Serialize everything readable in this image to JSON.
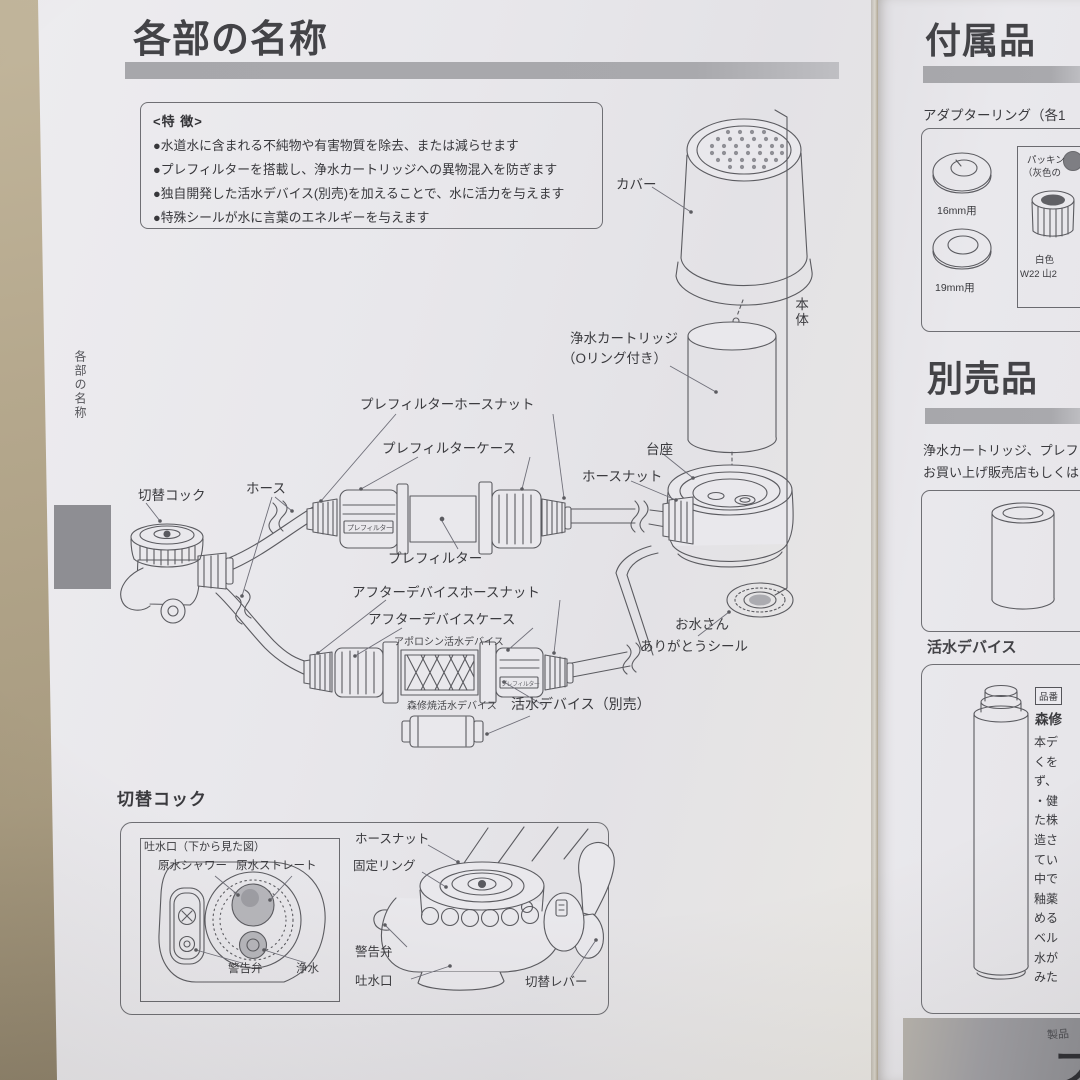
{
  "colors": {
    "table_surface": "#b3a68c",
    "paper": "#e8e7eb",
    "heading_bar": "#a9a9ad",
    "ink": "#3e3e42",
    "line_art": "#5b5b60"
  },
  "left_page": {
    "side_tab_label": "各部の名称",
    "title": "各部の名称",
    "features": {
      "heading": "<特 徴>",
      "items": [
        "●水道水に含まれる不純物や有害物質を除去、または減らせます",
        "●プレフィルターを搭載し、浄水カートリッジへの異物混入を防ぎます",
        "●独自開発した活水デバイス(別売)を加えることで、水に活力を与えます",
        "●特殊シールが水に言葉のエネルギーを与えます"
      ]
    },
    "diagram": {
      "cover": "カバー",
      "body": "本体",
      "cartridge_line1": "浄水カートリッジ",
      "cartridge_line2": "（Oリング付き）",
      "prefilter_hose_nut": "プレフィルターホースナット",
      "prefilter_case": "プレフィルターケース",
      "prefilter_case_marking": "プレフィルター",
      "base": "台座",
      "hose_nut": "ホースナット",
      "switch_cock": "切替コック",
      "hose": "ホース",
      "prefilter": "プレフィルター",
      "after_device_hose_nut": "アフターデバイスホースナット",
      "after_device_case": "アフターデバイスケース",
      "apolloshin_device": "アポロシン活水デバイス",
      "shinshuyaki_device": "森修焼活水デバイス",
      "kassui_device": "活水デバイス（別売）",
      "seal_line1": "お水さん",
      "seal_line2": "ありがとうシール"
    },
    "cock_section": {
      "heading": "切替コック",
      "bottom_view": {
        "title": "吐水口（下から見た図）",
        "shower": "原水シャワー",
        "straight": "原水ストレート",
        "warning_valve": "警告弁",
        "purified": "浄水"
      },
      "side_view": {
        "hose_nut": "ホースナット",
        "fixing_ring": "固定リング",
        "warning_valve": "警告弁",
        "spout": "吐水口",
        "switch_lever": "切替レバー"
      }
    }
  },
  "right_page": {
    "accessories": {
      "title": "付属品",
      "subtitle": "アダプターリング（各1",
      "ring16_label": "16mm用",
      "ring19_label": "19mm用",
      "packing_line1": "パッキン",
      "packing_line2": "（灰色の",
      "nut_line1": "白色",
      "nut_line2": "W22 山2"
    },
    "optional": {
      "title": "別売品",
      "text_line1": "浄水カートリッジ、プレフィ",
      "text_line2": "お買い上げ販売店もしくは"
    },
    "device_section": {
      "title": "活水デバイス",
      "part_no": "品番",
      "brand": "森修",
      "body_lines": [
        "本デ",
        "くを",
        "ず、",
        "・健",
        "た株",
        "造さ",
        "てい",
        "中で",
        "釉薬",
        "める",
        "ベル",
        "水が",
        "みた"
      ]
    },
    "footer": {
      "small_text": "製品",
      "large_text": "フ"
    }
  }
}
